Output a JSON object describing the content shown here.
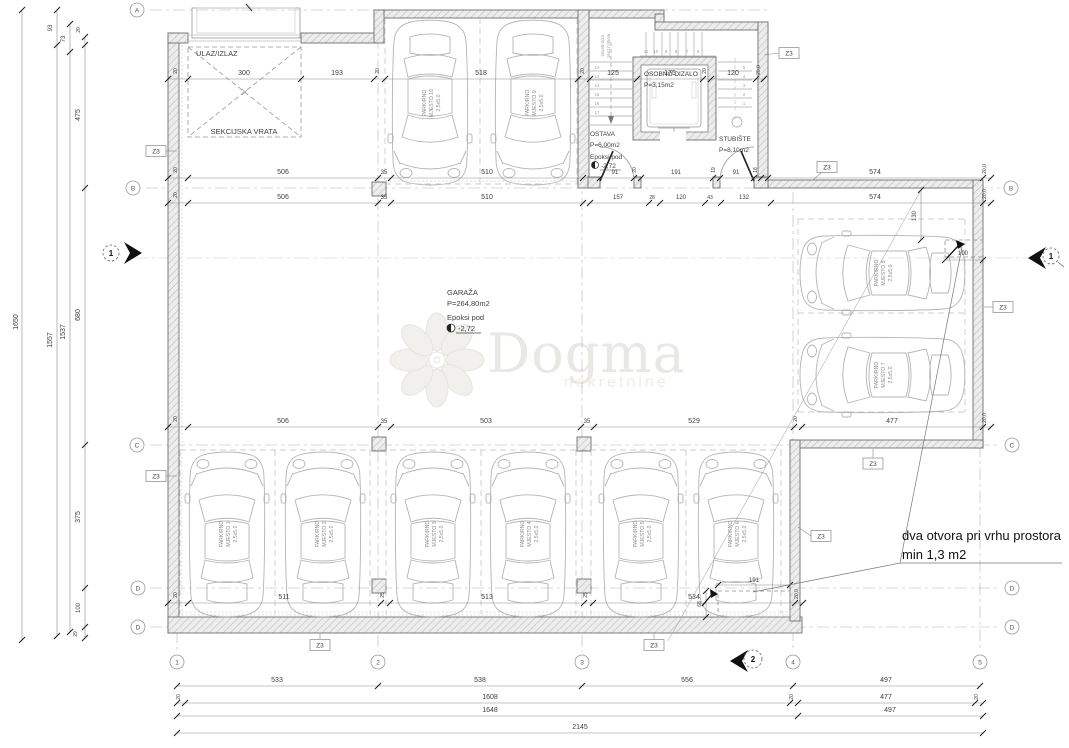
{
  "watermark": {
    "name": "Dogma",
    "tagline": "nekretnine"
  },
  "note": {
    "line1": "dva otvora pri vrhu prostora",
    "line2": "min 1,3 m2"
  },
  "rooms": {
    "garage": {
      "name": "GARAŽA",
      "area": "P=264,80m2",
      "floor": "Epoksi pod",
      "level": "-2,72"
    },
    "storage": {
      "name": "OSTAVA",
      "area": "P=6,00m2",
      "floor": "Epoksi pod",
      "level": "-2,72"
    },
    "elevator": {
      "name": "OSOBNO DIZALO",
      "area": "P=3,15m2"
    },
    "staircase": {
      "name": "STUBIŠTE",
      "area": "P=8,10m2",
      "riser1": "16x30,0cm",
      "riser2": "16x17,05cm"
    },
    "entry": "ULAZ/IZLAZ",
    "door": "SEKCIJSKA VRATA"
  },
  "parking": [
    {
      "l1": "PARKIRNO",
      "l2": "MJESTO 1",
      "l3": "2,5x5,0"
    },
    {
      "l1": "PARKIRNO",
      "l2": "MJESTO 2",
      "l3": "2,5x5,0"
    },
    {
      "l1": "PARKIRNO",
      "l2": "MJESTO 3",
      "l3": "2,5x5,0"
    },
    {
      "l1": "PARKIRNO",
      "l2": "MJESTO 4",
      "l3": "2,5x5,0"
    },
    {
      "l1": "PARKIRNO",
      "l2": "MJESTO 5",
      "l3": "2,5x5,0"
    },
    {
      "l1": "PARKIRNO",
      "l2": "MJESTO 6",
      "l3": "2,5x5,0"
    },
    {
      "l1": "PARKIRNO",
      "l2": "MJESTO 7",
      "l3": "2,5x5,0"
    },
    {
      "l1": "PARKIRNO",
      "l2": "MJESTO 8",
      "l3": "2,5x5,0"
    },
    {
      "l1": "PARKIRNO",
      "l2": "MJESTO 9",
      "l3": "2,5x5,0"
    },
    {
      "l1": "PARKIRNO",
      "l2": "MJESTO 10",
      "l3": "2,5x5,0"
    }
  ],
  "grid": {
    "a": "A",
    "b": "B",
    "c": "C",
    "d": "D",
    "cols": [
      "1",
      "2",
      "3",
      "4",
      "5"
    ]
  },
  "zone": "Z3",
  "sections": {
    "s1": "1",
    "s2": "2"
  },
  "stairs": {
    "top": [
      "11",
      "10",
      "9",
      "8",
      "7",
      "6"
    ],
    "left": [
      "12",
      "13",
      "14",
      "15",
      "16",
      "17"
    ],
    "right": [
      "5",
      "4",
      "3",
      "2",
      "1"
    ]
  },
  "dims": {
    "k20": "20",
    "k200": "20,0",
    "k35": "35",
    "k25": "25",
    "k28": "28",
    "k43": "43",
    "k19": "19",
    "k18": "18",
    "k29": "29",
    "k68": "68",
    "d300": "300",
    "d193": "193",
    "d518": "518",
    "d125": "125",
    "d175": "175",
    "d120": "120",
    "d506": "506",
    "d510": "510",
    "d91": "91",
    "d191": "191",
    "d574": "574",
    "d157": "157",
    "d132": "132",
    "d503": "503",
    "d529": "529",
    "d477": "477",
    "d511": "511",
    "d513": "513",
    "d534": "534",
    "d130": "130",
    "d100": "100",
    "d93": "93",
    "d73": "73",
    "d475": "475",
    "d680": "680",
    "d375": "375",
    "t1650": "1650",
    "t1557": "1557",
    "t1537": "1537",
    "d533": "533",
    "d538": "538",
    "d556": "556",
    "d497": "497",
    "d1608": "1608",
    "d1648": "1648",
    "d2145": "2145"
  }
}
